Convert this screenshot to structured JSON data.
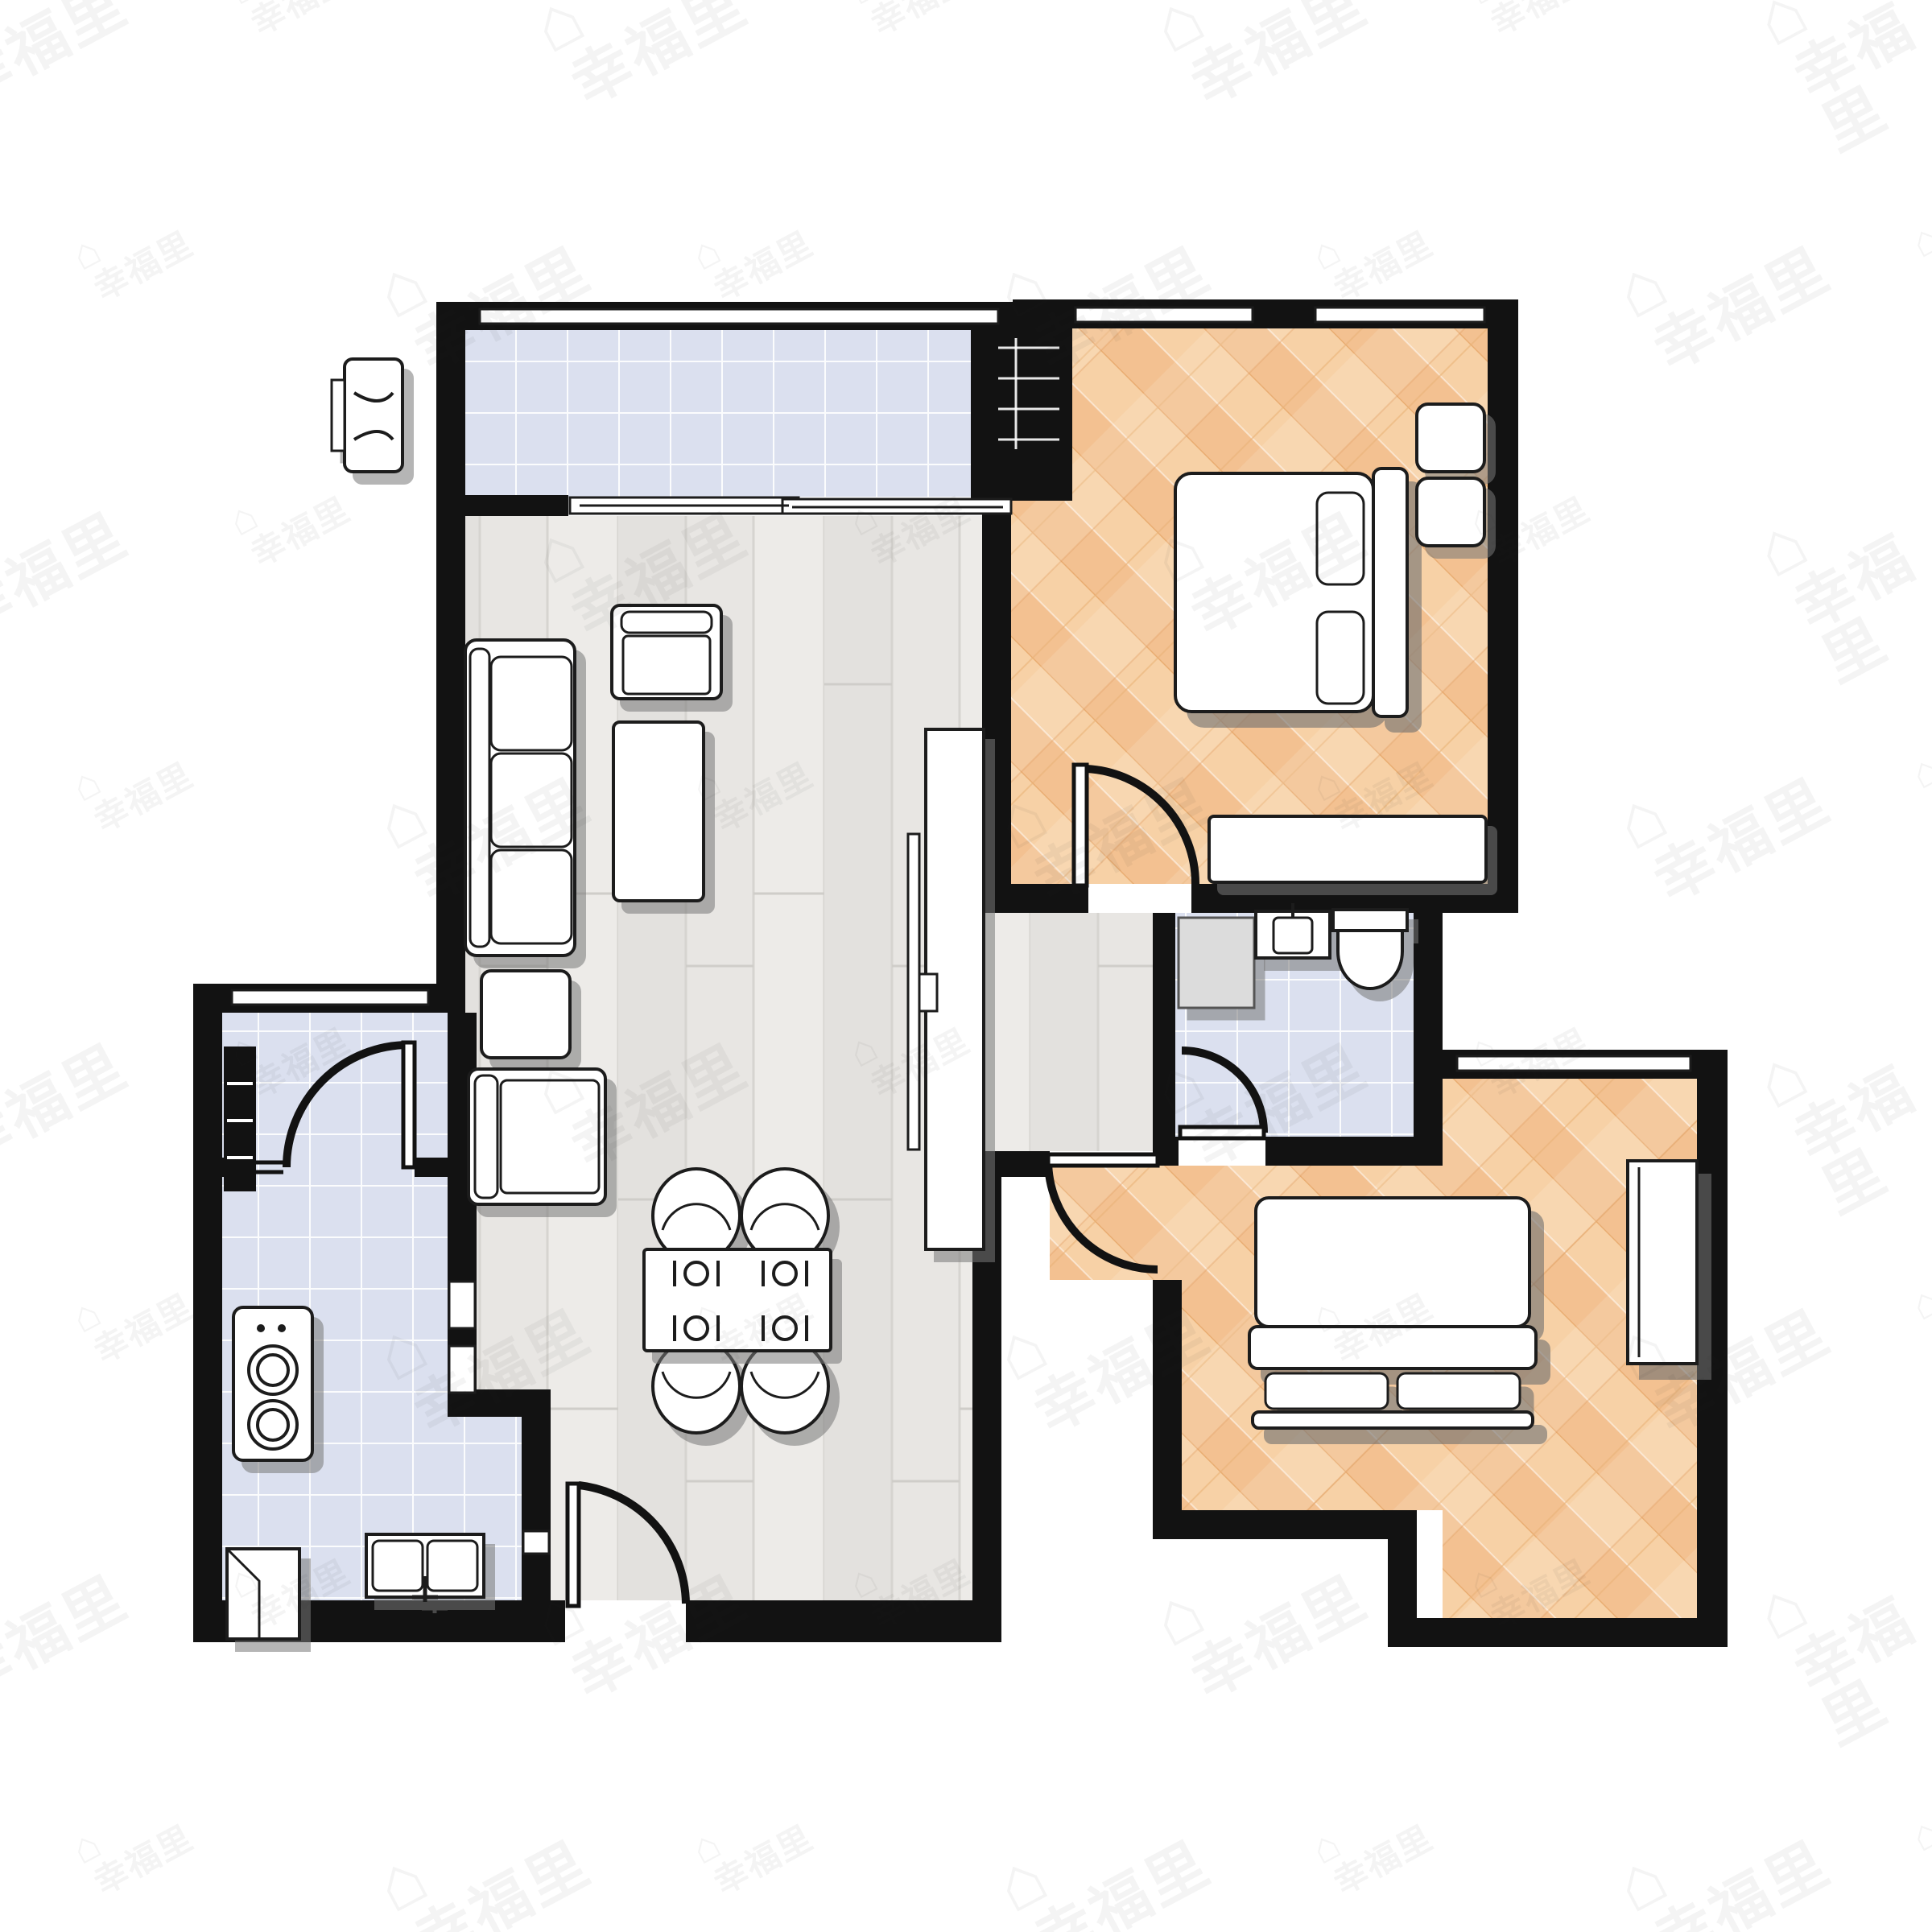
{
  "watermark": {
    "text": "幸福里",
    "icon": "house-icon",
    "color": "rgba(40,40,40,0.05)"
  },
  "palette": {
    "wall": "#121212",
    "background": "#ffffff",
    "tile_floor": "#dde2f0",
    "tile_grid_line": "#ffffff",
    "gray_wood_floor": "#e8e6e3",
    "herringbone_light": "#f7d1a6",
    "herringbone_dark": "#efbc85",
    "furniture_fill": "#ffffff",
    "furniture_line": "#1c1c1c",
    "appliance_gray": "#dcdcdc",
    "shadow_gray": "#777777"
  },
  "rooms": [
    {
      "name": "balcony",
      "floor": "blue-tile",
      "fixtures": [
        "sliding-door",
        "window"
      ]
    },
    {
      "name": "living-dining-room",
      "floor": "gray-wood",
      "fixtures": [
        "sofa",
        "armchair",
        "coffee-table",
        "side-table",
        "tv-console",
        "tv",
        "dining-table",
        "dining-chairs"
      ]
    },
    {
      "name": "bedroom-1",
      "floor": "herringbone-wood",
      "fixtures": [
        "double-bed",
        "pillows",
        "nightstands",
        "dresser",
        "door",
        "windows"
      ]
    },
    {
      "name": "bathroom",
      "floor": "blue-tile",
      "fixtures": [
        "toilet",
        "sink",
        "washing-machine",
        "door"
      ]
    },
    {
      "name": "bedroom-2",
      "floor": "herringbone-wood",
      "fixtures": [
        "double-bed",
        "pillows",
        "wardrobe",
        "door",
        "window"
      ]
    },
    {
      "name": "entry-hall",
      "floor": "blue-tile",
      "fixtures": [
        "front-door",
        "shoe-cabinet",
        "window"
      ]
    },
    {
      "name": "kitchen",
      "floor": "blue-tile",
      "fixtures": [
        "stove",
        "sink",
        "refrigerator",
        "pass-through"
      ]
    },
    {
      "name": "exterior",
      "fixtures": [
        "air-conditioner-unit",
        "utility-shaft"
      ]
    }
  ]
}
